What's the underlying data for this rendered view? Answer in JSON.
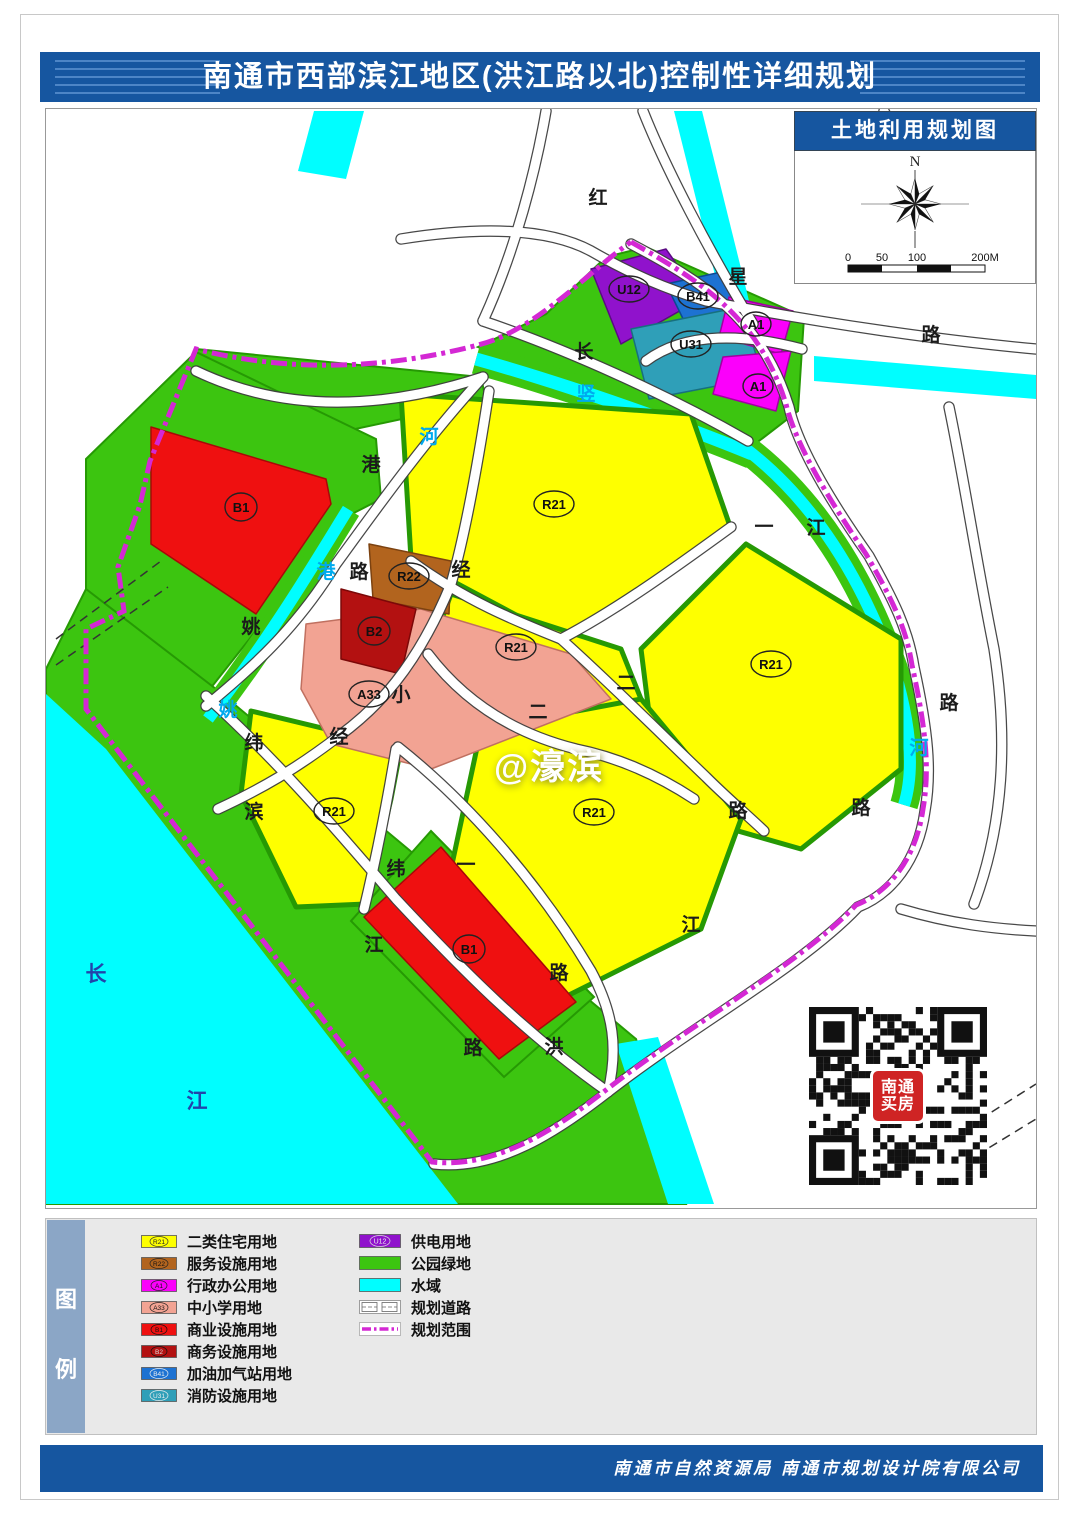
{
  "title": {
    "text": "南通市西部滨江地区(洪江路以北)控制性详细规划"
  },
  "inset": {
    "title": "土地利用规划图",
    "north_label": "N",
    "scale_labels": [
      "0",
      "50",
      "100",
      "200M"
    ]
  },
  "map": {
    "road_labels": [
      "红",
      "星",
      "路",
      "长",
      "竖",
      "河",
      "港",
      "港",
      "路",
      "姚",
      "姚",
      "经",
      "经",
      "纬",
      "滨",
      "一",
      "纬",
      "江",
      "路",
      "路",
      "洪",
      "江",
      "路",
      "路",
      "二",
      "二",
      "一",
      "江",
      "路",
      "河",
      "长",
      "江"
    ],
    "zone_badges": [
      "U12",
      "B41",
      "A1",
      "U31",
      "A1",
      "B1",
      "R22",
      "B2",
      "A33",
      "R21",
      "R21",
      "R21",
      "R21",
      "R21",
      "B1"
    ],
    "school_char": "小",
    "watermark": "@濠滨"
  },
  "qr": {
    "logo_line1": "南通",
    "logo_line2": "买房"
  },
  "legend": {
    "panel_label": [
      "图",
      "例"
    ],
    "left": [
      {
        "code": "R21",
        "color": "#feff00",
        "label": "二类住宅用地"
      },
      {
        "code": "R22",
        "color": "#b2641e",
        "label": "服务设施用地"
      },
      {
        "code": "A1",
        "color": "#fb00fb",
        "label": "行政办公用地"
      },
      {
        "code": "A33",
        "color": "#f2a393",
        "label": "中小学用地"
      },
      {
        "code": "B1",
        "color": "#ef1010",
        "label": "商业设施用地"
      },
      {
        "code": "B2",
        "color": "#b31111",
        "label": "商务设施用地"
      },
      {
        "code": "B41",
        "color": "#1d72d2",
        "label": "加油加气站用地"
      },
      {
        "code": "U31",
        "color": "#2f9fb8",
        "label": "消防设施用地"
      }
    ],
    "right": [
      {
        "code": "U12",
        "color": "#9012cc",
        "label": "供电用地"
      },
      {
        "code": "",
        "color": "#3cc510",
        "label": "公园绿地"
      },
      {
        "code": "",
        "color": "#00feff",
        "label": "水域"
      },
      {
        "code": "",
        "color": "#ffffff",
        "label": "规划道路"
      },
      {
        "code": "",
        "color": "#d428d4",
        "label": "规划范围"
      }
    ]
  },
  "footer": {
    "text": "南通市自然资源局  南通市规划设计院有限公司"
  },
  "colors": {
    "banner": "#1656a0",
    "r21": "#feff00",
    "r22": "#b2641e",
    "a1": "#fb00fb",
    "a33": "#f2a393",
    "b1": "#ef1010",
    "b2": "#b31111",
    "b41": "#1d72d2",
    "u31": "#2f9fb8",
    "u12": "#9012cc",
    "green": "#3cc510",
    "water": "#00feff",
    "boundary": "#d428d4"
  }
}
